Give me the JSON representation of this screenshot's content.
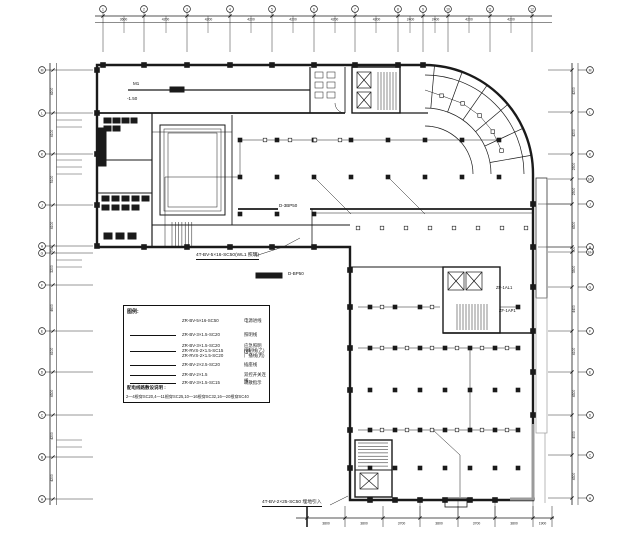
{
  "drawing": {
    "line_color": "#1a1a1a",
    "gray_color": "#9b9b9b",
    "background": "#ffffff"
  },
  "axes": {
    "top": {
      "labels": [
        "1",
        "2",
        "3",
        "4",
        "5",
        "6",
        "7",
        "8",
        "9",
        "10",
        "11",
        "12"
      ],
      "dims": [
        "3600",
        "4200",
        "4200",
        "4200",
        "4200",
        "4200",
        "4200",
        "2400",
        "2400",
        "4200",
        "4200"
      ]
    },
    "left": {
      "labels": [
        "M",
        "L",
        "K",
        "J",
        "H",
        "G",
        "F",
        "E",
        "D",
        "C",
        "B",
        "A"
      ],
      "dims": [
        "4200",
        "4100",
        "5100",
        "4100",
        "700",
        "3200",
        "4600",
        "4100",
        "4300",
        "4200",
        "4200"
      ]
    },
    "right": {
      "labels": [
        "M",
        "L",
        "K",
        "1/K",
        "J",
        "H",
        "1/H",
        "G",
        "F",
        "E",
        "D",
        "C",
        "A"
      ],
      "dims": [
        "4200",
        "4200",
        "2500",
        "2500",
        "4300",
        "500",
        "3500",
        "4400",
        "4100",
        "4300",
        "4000",
        "4300"
      ]
    },
    "bottom": {
      "dims": [
        "3800",
        "3800",
        "3700",
        "3800",
        "3700",
        "3800",
        "1900"
      ]
    }
  },
  "legend": {
    "title": "图例:",
    "rows": [
      {
        "code": "ZR-BV-5×16-SC50",
        "desc": "电源进线",
        "sample": false
      },
      {
        "code": "ZR-BV-3×1.5-SC20",
        "desc": "照明线",
        "sample": true
      },
      {
        "code": "ZR-BV-3×1.5-SC20",
        "desc": "应急照明(甲)",
        "sample": false
      },
      {
        "code": "ZR-RVS-2×1.5-SC15",
        "desc": "控制线(乙)",
        "sample": true
      },
      {
        "code": "ZR-RVS-2×1.5-SC20",
        "desc": "广播线(丙)",
        "sample": false
      },
      {
        "code": "ZR-BV-2×2.5-SC20",
        "desc": "插座线",
        "sample": true
      },
      {
        "code": "ZR-BV-2×1.5",
        "desc": "双控开关连线",
        "sample": true
      },
      {
        "code": "ZR-BV-3×1.5-SC15",
        "desc": "疏散指示",
        "sample": true
      }
    ],
    "note_title": "配电线路敷设说明 :",
    "note": "2—4根穿SC20,4—11根穿SC25,10—16根穿SC32,16—20根穿SC40"
  },
  "annotations": {
    "feeder_label": "4T-BV-5×16-SC50(WL1 照明)",
    "dist_box_label": "D-BP50",
    "wall_label": "D-3BP50",
    "bottom_label": "4T-BV-2×25-SC50 埋地引入",
    "level_label": "-1.50",
    "door_label": "M1",
    "panel_label_1": "ZF-1AL1",
    "panel_label_2": "ZF-1AP1"
  }
}
